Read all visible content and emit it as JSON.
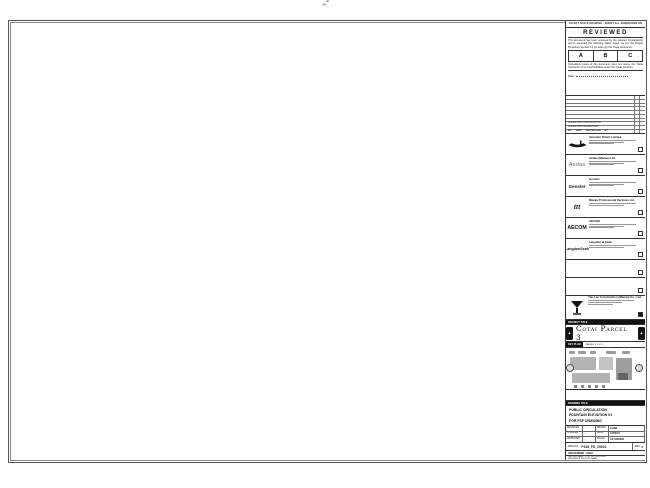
{
  "header": {
    "note": "DO NOT SCALE DRAWING · VERIFY ALL DIMENSIONS ON SITE"
  },
  "stamp": {
    "title": "REVIEWED",
    "para1": "This document has been reviewed by the relevant Consultant(s) and is accorded the following status noted, as per the Project Procedure Section 5.4 for action by the Trade Contractor.",
    "grades": [
      "A",
      "B",
      "C"
    ],
    "para2": "Consultant review of this document does not relieve the Trade Contractor of its responsibilities under the Trade Contract.",
    "date_label": "Date :"
  },
  "revisions": {
    "header": {
      "no": "NO.",
      "date": "DATE",
      "desc": "DESCRIPTION",
      "by": "BY"
    },
    "rows": [
      {
        "desc": "ISSUED FOR CONSTRUCTION"
      },
      {
        "desc": "ISSUED FOR INFORMATION"
      }
    ]
  },
  "consultants": [
    {
      "name": "Venetian Orient Limited",
      "logo": "gondola"
    },
    {
      "name": "Aedas (Macau) Ltd.",
      "logo": "Aedas"
    },
    {
      "name": "Gensler",
      "logo": "Gensler"
    },
    {
      "name": "Macau Professional Services Ltd.",
      "logo": "ttt"
    },
    {
      "name": "AECOM",
      "logo": "AECOM"
    },
    {
      "name": "Langdon & Seah",
      "logo": "LangdonSeah"
    }
  ],
  "contractor": {
    "name": "Yau Lee Construction (Macau) Co., Ltd."
  },
  "project": {
    "label": "PROJECT TITLE",
    "title": "Cotai Parcel 3"
  },
  "key_plan": {
    "label": "KEY PLAN",
    "note": "PARCEL 3, LOT 3"
  },
  "title_block": {
    "label": "DRAWING TITLE",
    "line1": "PUBLIC CIRCULATION",
    "line2": "FOUNTAIN ELEVATION 01",
    "line3": "FOR FSF DRAWING"
  },
  "info": {
    "designed_label": "DESIGNED",
    "designed": "-",
    "checked_label": "CHECKED",
    "checked": "-",
    "approved_label": "APPROVED",
    "approved": "-",
    "drawn_label": "DRAWN",
    "drawn": "CHAD",
    "date_label": "DATE",
    "date": "12/04/16",
    "scale_label": "SCALE",
    "scale": "AS SHOWN"
  },
  "dwg": {
    "no_label": "DWG NO :",
    "no": "P318_FD_25101",
    "rev_label": "REV",
    "rev": "0"
  },
  "job": {
    "label": "JOB NUMBER :  31123"
  },
  "file": {
    "cad": "CAD FILE NAME : P318_FD_25101.DWG",
    "ref": "REFERENCE DWG FILE NAME :"
  },
  "drawing": {
    "levels": [
      {
        "label": "F.F.L + 7500"
      },
      {
        "label": "F.F.L + 6750"
      },
      {
        "label": "F.F.L + 4750"
      },
      {
        "label": "F.F.L"
      }
    ],
    "vdims": {
      "v7500": "7500",
      "v6750": "6750",
      "v4750": "4750",
      "v750": "750"
    },
    "top_dims": [
      "450",
      "450"
    ],
    "upper_dims": [
      "1140",
      "1140"
    ],
    "lamp_dims": [
      "450",
      "1050"
    ],
    "bottom_dims_left": [
      "320",
      "455",
      "1180",
      "1750"
    ],
    "bottom_dims_right": [
      "660",
      "2180",
      "1100",
      "1370"
    ],
    "overall_dim": "19500",
    "elevation": {
      "tag": "01",
      "label": "ELEVATION 01",
      "scale": "SCALE 1 : 50"
    }
  }
}
